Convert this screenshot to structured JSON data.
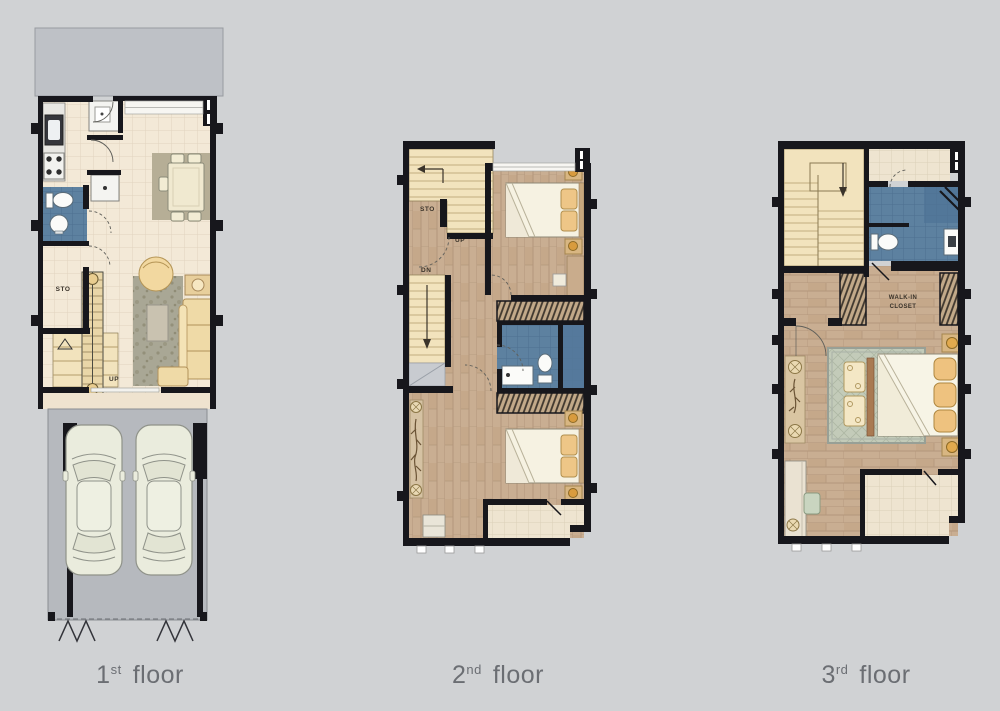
{
  "image_type": "architectural-floor-plan-set",
  "colors": {
    "background": "#d0d2d4",
    "wall": "#17171c",
    "bath_tile": "#5d81a0",
    "wood_floor": "#c9ae92",
    "cream_tile": "#f3e9d7",
    "stairs": "#f2e3bd",
    "garage_floor": "#b6b9be",
    "yard": "#bec1c6",
    "rug_living": "#a9a795",
    "rug_master": "#c3cbb9",
    "sofa": "#efdaa7",
    "label_text": "#6b6e73"
  },
  "floor_labels": [
    {
      "number": "1",
      "ordinal": "st",
      "word": "floor"
    },
    {
      "number": "2",
      "ordinal": "nd",
      "word": "floor"
    },
    {
      "number": "3",
      "ordinal": "rd",
      "word": "floor"
    }
  ],
  "annotations": {
    "floor1": {
      "storage": "STO",
      "up": "UP"
    },
    "floor2": {
      "storage": "STO",
      "up": "UP",
      "down": "DN"
    },
    "floor3": {
      "closet_line1": "WALK-IN",
      "closet_line2": "CLOSET"
    }
  }
}
